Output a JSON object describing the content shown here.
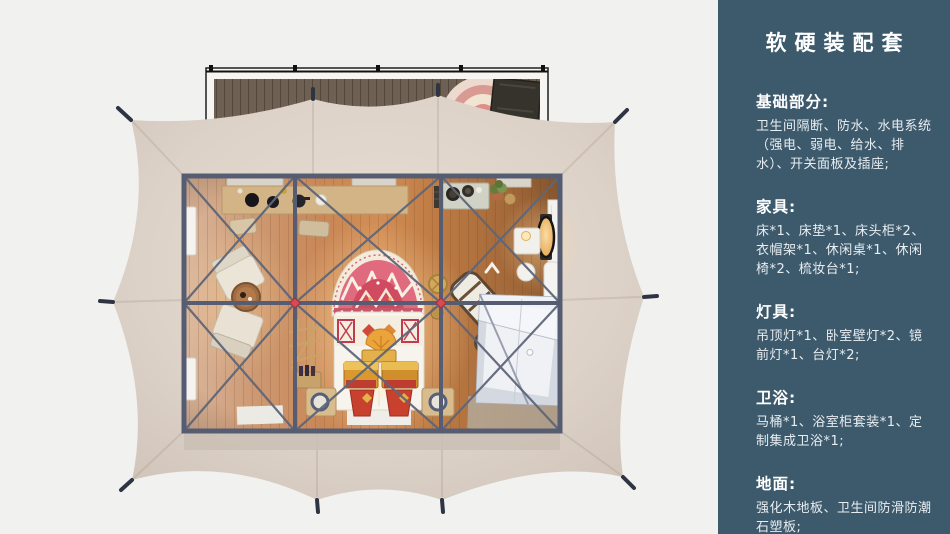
{
  "panel": {
    "title": "软硬装配套",
    "bg_color": "#3d5a6c",
    "text_color": "#ffffff",
    "sections": [
      {
        "heading": "基础部分:",
        "body": "卫生间隔断、防水、水电系统（强电、弱电、给水、排水）、开关面板及插座;"
      },
      {
        "heading": "家具:",
        "body": "床*1、床垫*1、床头柜*2、衣帽架*1、休闲桌*1、休闲椅*2、梳妆台*1;"
      },
      {
        "heading": "灯具:",
        "body": "吊顶灯*1、卧室壁灯*2、镜前灯*1、台灯*2;"
      },
      {
        "heading": "卫浴:",
        "body": "马桶*1、浴室柜套装*1、定制集成卫浴*1;"
      },
      {
        "heading": "地面:",
        "body": "强化木地板、卫生间防滑防潮石塑板;"
      }
    ]
  },
  "floorplan": {
    "view": "top-down 3D render of a glamping tent suite",
    "colors": {
      "background": "#f1f1f0",
      "tent_canvas": "#ddd2c8",
      "frame_beams": "#59617a",
      "wood_floor_warm": "#c98757",
      "deck_wood": "#6e6052",
      "bathroom_pod": "#dde1e8",
      "connector_node_red": "#d84a55"
    },
    "items": [
      "entry-deck",
      "deck-rug",
      "deck-bench",
      "tent-canvas",
      "anchor-stakes",
      "console-desk",
      "stools",
      "window-panels",
      "lounge-chairs",
      "round-tea-table",
      "coat-rack",
      "bottle-stand",
      "bed",
      "headboard-rug",
      "painted-chests",
      "nightstands",
      "folding-deck-chairs",
      "drum-table",
      "kitchen-console",
      "plant",
      "vanity-mirror",
      "vanity-table",
      "vanity-stool",
      "bathroom-pod",
      "floor-mats"
    ]
  }
}
